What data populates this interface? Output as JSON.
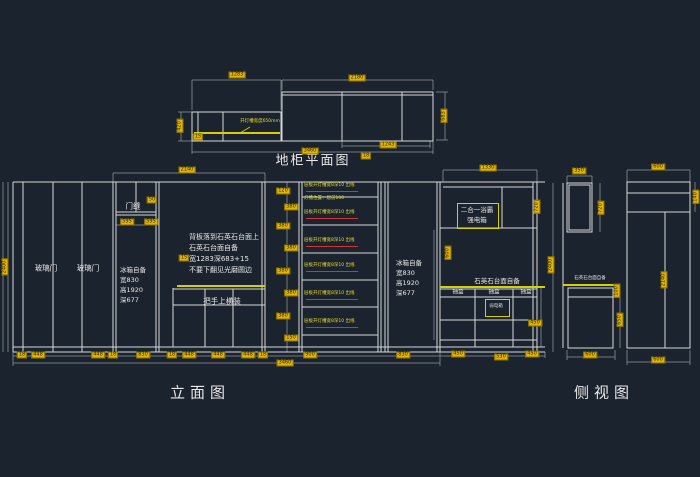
{
  "colors": {
    "background": "#1b232e",
    "line": "#d4d8da",
    "dim_line": "#8f979e",
    "dim_tag": "#e0b400",
    "groove_yellow": "#d8cf00",
    "led_red": "#cf3333"
  },
  "plan": {
    "title": "地柜平面图",
    "light_note": "开灯槽宽度650mm"
  },
  "elevation": {
    "title": "立面图",
    "glass_door_1": "玻璃门",
    "glass_door_2": "玻璃门",
    "door_gap": "门缝",
    "fridge_left": {
      "l1": "冰箱自备",
      "l2": "宽830",
      "l3": "高1920",
      "l4": "深677"
    },
    "back_panel_note": {
      "l1": "背板落到石英石台面上",
      "l2": "石英石台面自备",
      "l3": "宽1283深683+15",
      "l4": "不要下翻见光磨圆边"
    },
    "handle_note": "把手上横装",
    "shelf_note": "层板开灯槽宽8深10 出线",
    "shelf_note_line2": "灯槽位置：居前100",
    "fridge_right": {
      "l1": "冰箱自备",
      "l2": "宽830",
      "l3": "高1920",
      "l4": "深677"
    },
    "bath_heater": {
      "l1": "二合一浴霸",
      "l2": "强电箱"
    },
    "counter_note": "石英石台面自备",
    "drawer_1": "抽盒",
    "drawer_2": "抽盒",
    "drawer_3": "抽盒",
    "weak_box": "弱电箱"
  },
  "side_view": {
    "title": "侧视图",
    "counter_note": "石英石台面自备"
  },
  "shelf_rows": [
    {
      "y": 186,
      "line2": true
    },
    {
      "y": 213
    },
    {
      "y": 241
    },
    {
      "y": 266
    },
    {
      "y": 294
    },
    {
      "y": 322
    }
  ],
  "dim_labels": [
    {
      "x": 237,
      "y": 75,
      "t": "1283"
    },
    {
      "x": 357,
      "y": 78,
      "t": "2180"
    },
    {
      "x": 180,
      "y": 126,
      "t": "420",
      "r": 1
    },
    {
      "x": 444,
      "y": 116,
      "t": "683",
      "r": 1
    },
    {
      "x": 388,
      "y": 145,
      "t": "1243"
    },
    {
      "x": 310,
      "y": 151,
      "t": "3460"
    },
    {
      "x": 198,
      "y": 137,
      "t": "15"
    },
    {
      "x": 366,
      "y": 156,
      "t": "18"
    },
    {
      "x": 187,
      "y": 170,
      "t": "2140"
    },
    {
      "x": 488,
      "y": 168,
      "t": "1330"
    },
    {
      "x": 152,
      "y": 200,
      "t": "50"
    },
    {
      "x": 127,
      "y": 222,
      "t": "595"
    },
    {
      "x": 151,
      "y": 222,
      "t": "595"
    },
    {
      "x": 5,
      "y": 267,
      "t": "2400",
      "r": 1
    },
    {
      "x": 184,
      "y": 258,
      "t": "15"
    },
    {
      "x": 283,
      "y": 191,
      "t": "120"
    },
    {
      "x": 291,
      "y": 207,
      "t": "380"
    },
    {
      "x": 283,
      "y": 226,
      "t": "380"
    },
    {
      "x": 291,
      "y": 248,
      "t": "380"
    },
    {
      "x": 283,
      "y": 271,
      "t": "380"
    },
    {
      "x": 291,
      "y": 293,
      "t": "380"
    },
    {
      "x": 283,
      "y": 316,
      "t": "380"
    },
    {
      "x": 291,
      "y": 338,
      "t": "150"
    },
    {
      "x": 448,
      "y": 253,
      "t": "600",
      "r": 1
    },
    {
      "x": 537,
      "y": 207,
      "t": "720",
      "r": 1
    },
    {
      "x": 535,
      "y": 323,
      "t": "450"
    },
    {
      "x": 22,
      "y": 355,
      "t": "18"
    },
    {
      "x": 38,
      "y": 355,
      "t": "448"
    },
    {
      "x": 98,
      "y": 355,
      "t": "448"
    },
    {
      "x": 113,
      "y": 355,
      "t": "18"
    },
    {
      "x": 143,
      "y": 355,
      "t": "830"
    },
    {
      "x": 172,
      "y": 355,
      "t": "18"
    },
    {
      "x": 189,
      "y": 355,
      "t": "448"
    },
    {
      "x": 218,
      "y": 355,
      "t": "448"
    },
    {
      "x": 248,
      "y": 355,
      "t": "448"
    },
    {
      "x": 263,
      "y": 355,
      "t": "18"
    },
    {
      "x": 310,
      "y": 355,
      "t": "900"
    },
    {
      "x": 403,
      "y": 355,
      "t": "830"
    },
    {
      "x": 458,
      "y": 354,
      "t": "450"
    },
    {
      "x": 501,
      "y": 357,
      "t": "530"
    },
    {
      "x": 532,
      "y": 354,
      "t": "450"
    },
    {
      "x": 285,
      "y": 363,
      "t": "3460"
    },
    {
      "x": 579,
      "y": 171,
      "t": "350"
    },
    {
      "x": 601,
      "y": 208,
      "t": "720",
      "r": 1
    },
    {
      "x": 551,
      "y": 265,
      "t": "2400",
      "r": 1
    },
    {
      "x": 617,
      "y": 291,
      "t": "100",
      "r": 1
    },
    {
      "x": 620,
      "y": 320,
      "t": "650",
      "r": 1
    },
    {
      "x": 590,
      "y": 355,
      "t": "600"
    },
    {
      "x": 658,
      "y": 167,
      "t": "600"
    },
    {
      "x": 696,
      "y": 197,
      "t": "140",
      "r": 1
    },
    {
      "x": 664,
      "y": 280,
      "t": "2140",
      "r": 1
    },
    {
      "x": 658,
      "y": 360,
      "t": "600"
    }
  ]
}
